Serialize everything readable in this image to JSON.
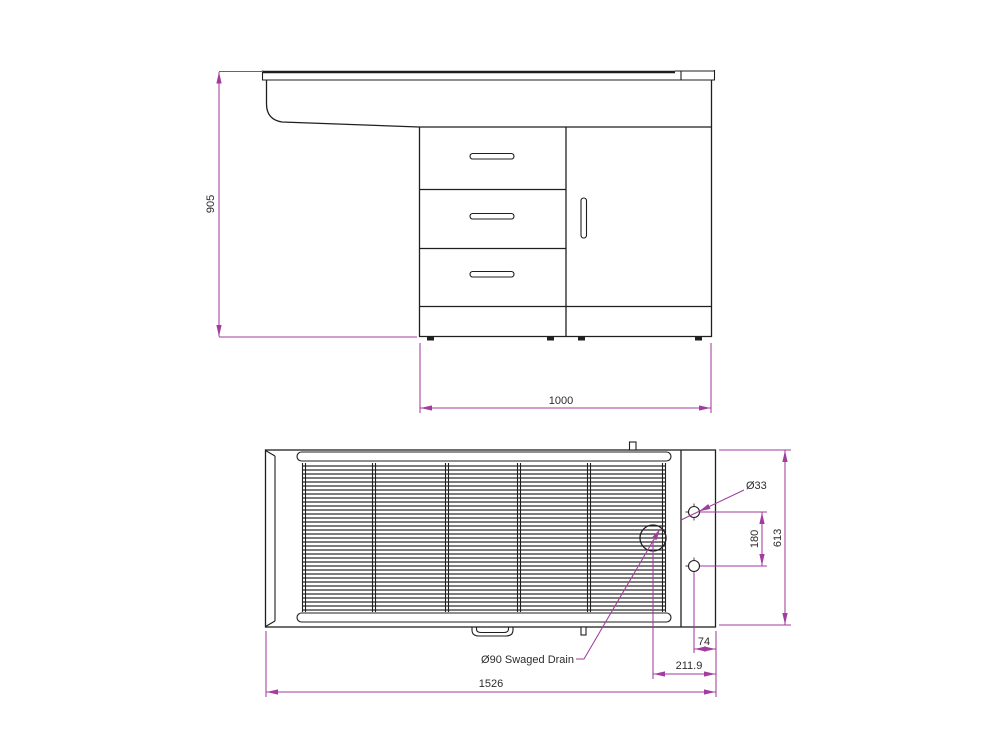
{
  "drawing_type": "2-view technical drawing of sink unit with drawer cabinet",
  "colors": {
    "background": "#FFFFFF",
    "drawing_line": "#1F1F1F",
    "dimension_line": "#A23C9E",
    "text": "#2B2B2B"
  },
  "front_view": {
    "description": "front elevation: worktop with bowl apron, 3-drawer stack and single door cupboard on plinth",
    "drawer_count": 3,
    "height_dim": "905",
    "width_dim": "1000"
  },
  "plan_view": {
    "description": "plan view: ribbed drainer tray with right-hand tap ledge, two tap holes and swaged drain",
    "grill_section_count": 5,
    "tap_hole_count": 2,
    "length_dim": "1526",
    "depth_dim": "613",
    "hole_spacing_dim": "180",
    "hole_edge_dim": "74",
    "drain_offset_dim": "211.9",
    "hole_diameter_label": "Ø33",
    "drain_label": "Ø90 Swaged Drain"
  }
}
